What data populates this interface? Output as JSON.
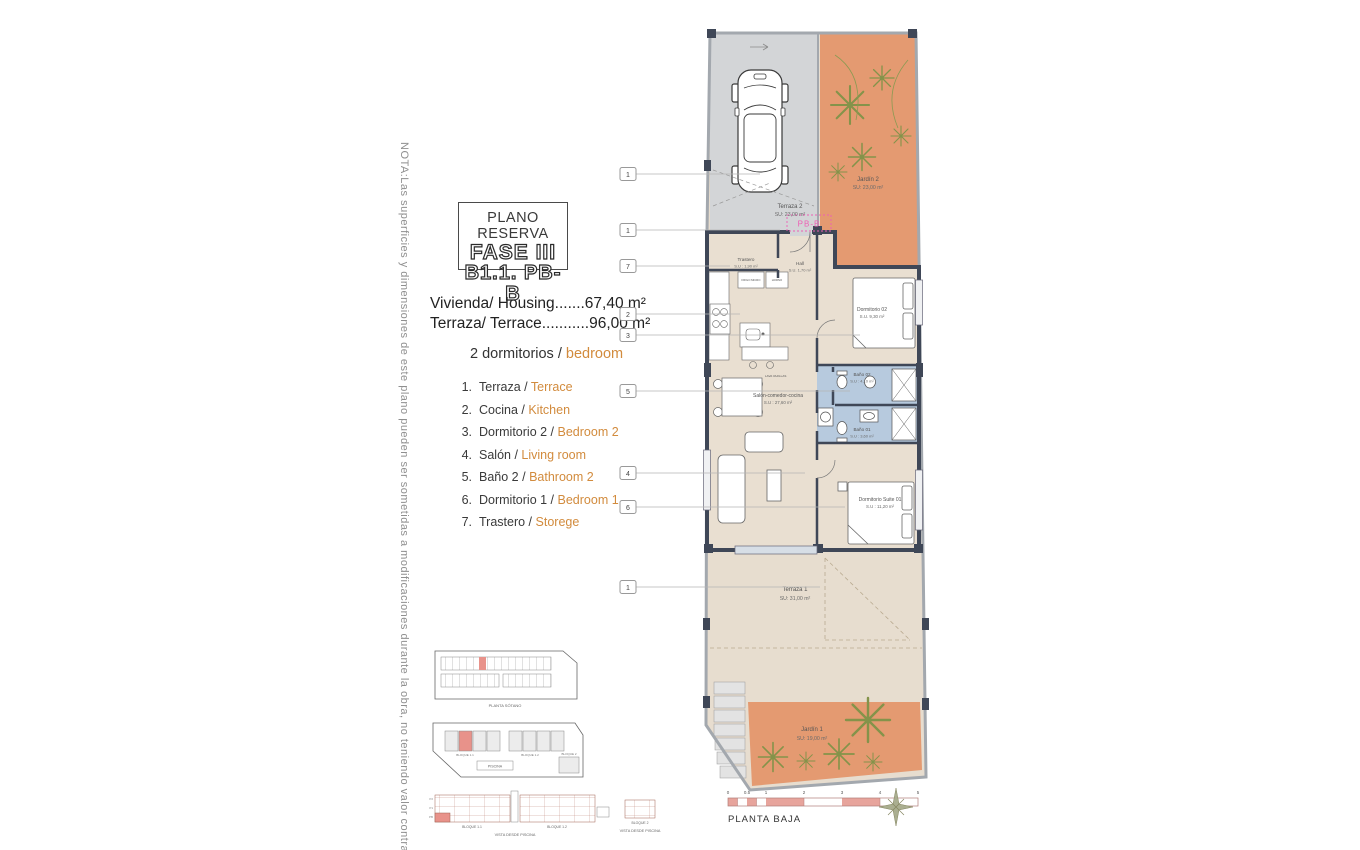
{
  "note": "NOTA:Las superficies y dimensiones de este plano pueden ser sometidas a modificaciones durante la obra, no teniendo valor contractual.",
  "title_block": {
    "subtitle": "PLANO RESERVA",
    "phase": "FASE III",
    "unit": "B1.1. PB-B"
  },
  "summary": {
    "housing": "Vivienda/ Housing.......67,40 m²",
    "terrace": "Terraza/ Terrace...........96,00 m²",
    "bedrooms_es": "2 dormitorios /",
    "bedrooms_en": "bedroom"
  },
  "legend": {
    "items": [
      {
        "num": "1.",
        "es": "Terraza /",
        "en": "Terrace"
      },
      {
        "num": "2.",
        "es": "Cocina /",
        "en": "Kitchen"
      },
      {
        "num": "3.",
        "es": "Dormitorio 2 /",
        "en": "Bedroom 2"
      },
      {
        "num": "4.",
        "es": "Salón /",
        "en": "Living room"
      },
      {
        "num": "5.",
        "es": "Baño 2 /",
        "en": "Bathroom 2"
      },
      {
        "num": "6.",
        "es": "Dormitorio 1 /",
        "en": "Bedroom 1"
      },
      {
        "num": "7.",
        "es": "Trastero /",
        "en": "Storege"
      }
    ]
  },
  "plan": {
    "unit_tag": "PB-B",
    "caption": "PLANTA BAJA",
    "rooms": {
      "terraza2": {
        "name": "Terraza 2",
        "area": "SU: 23,00 m²"
      },
      "jardin2": {
        "name": "Jardín 2",
        "area": "SU: 23,00 m²"
      },
      "trastero": {
        "name": "Trastero",
        "area": "S.U : 1,90 m²"
      },
      "hall": {
        "name": "Hall",
        "area": "S.U. 1,70 m²"
      },
      "dormitorio02": {
        "name": "Dormitorio 02",
        "area": "S.U. 9,30 m²"
      },
      "bano02": {
        "name": "Baño 02",
        "area": "S.U : 4,10 m²"
      },
      "bano01": {
        "name": "Baño 01",
        "area": "S.U : 3,60 m²"
      },
      "salon": {
        "name": "Salón-comedor-cocina",
        "area": "S.U : 27,60 m²"
      },
      "suite": {
        "name": "Dormitorio Suite 01",
        "area": "S.U : 11,20 m²"
      },
      "terraza1": {
        "name": "Terraza 1",
        "area": "SU: 31,00 m²"
      },
      "jardin1": {
        "name": "Jardín 1",
        "area": "SU: 19,00 m²"
      }
    },
    "kitchen_labels": {
      "fridge": "FRIGO MICRO",
      "oven": "HORNO",
      "dishwasher": "LAVA VAJILLAS"
    },
    "callouts": [
      {
        "num": "1"
      },
      {
        "num": "1"
      },
      {
        "num": "7"
      },
      {
        "num": "2"
      },
      {
        "num": "3"
      },
      {
        "num": "5"
      },
      {
        "num": "4"
      },
      {
        "num": "6"
      },
      {
        "num": "1"
      }
    ],
    "scale": {
      "ticks": [
        "0",
        "0.5",
        "1",
        "2",
        "3",
        "4",
        "5"
      ]
    }
  },
  "site_diagrams": {
    "parking_caption": "PLANTA SÓTANO",
    "block11": "BLOQUE 1.1",
    "block12": "BLOQUE 1.2",
    "block2": "BLOQUE 2",
    "pool": "PISCINA",
    "view_caption": "VISTA DESDE PISCINA",
    "floors": [
      "P2",
      "P1",
      "PB"
    ]
  },
  "colors": {
    "garden": "#e49a71",
    "bath": "#b7cade",
    "interior": "#e9dfd1",
    "terrace_gray": "#d3d5d7",
    "wall": "#3f4757",
    "accent_pink": "#ee5fb5",
    "accent_orange": "#d28b3d",
    "scale_pink": "#e7a49c",
    "highlight_red": "#e8928a"
  }
}
